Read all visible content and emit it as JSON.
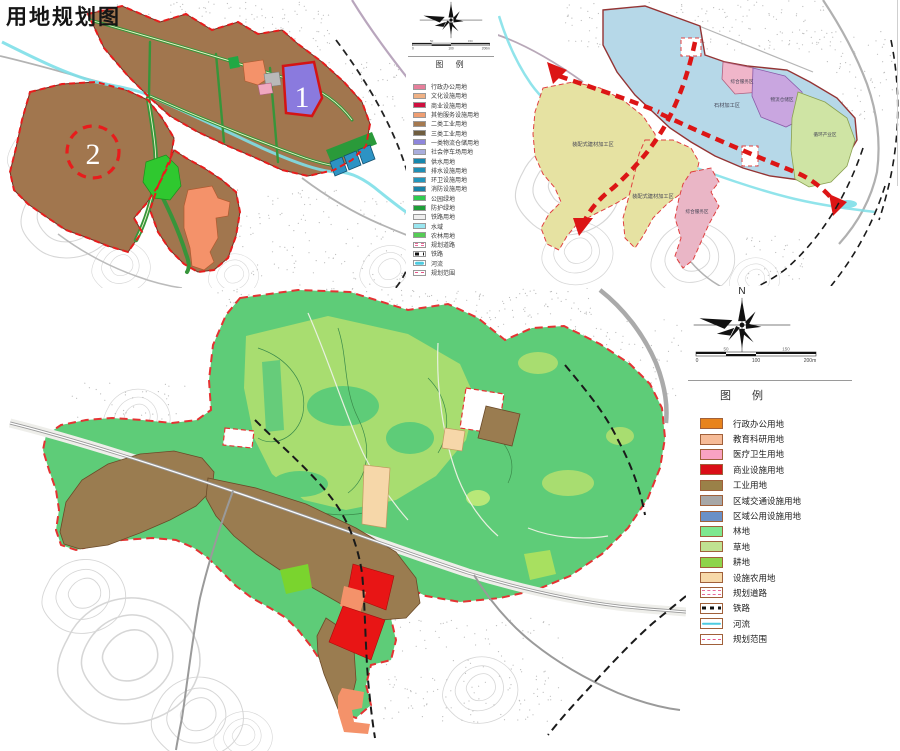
{
  "title": "用地规划图",
  "map1": {
    "marker_1": "1",
    "marker_2": "2"
  },
  "map2": {
    "zones": {
      "stone": "石材加工区",
      "prefab_west": "装配式建材加工区",
      "prefab_south": "装配式建材加工区",
      "service_top": "综合服务区",
      "logistics": "物流仓储区",
      "recycle": "循环产业区",
      "service_south": "综合服务区"
    }
  },
  "legend1": {
    "title": "图 例",
    "scale": {
      "start": "0",
      "mid": "100",
      "end": "200m",
      "upper_left": "50",
      "upper_right": "150"
    },
    "items": [
      {
        "label": "行政办公用地",
        "color": "#e67f9b",
        "style": "solid"
      },
      {
        "label": "文化设施用地",
        "color": "#efb184",
        "style": "solid"
      },
      {
        "label": "商业设施用地",
        "color": "#cf0f3f",
        "style": "solid"
      },
      {
        "label": "其他服务设施用地",
        "color": "#ef9e72",
        "style": "solid"
      },
      {
        "label": "二类工业用地",
        "color": "#a5794f",
        "style": "solid"
      },
      {
        "label": "三类工业用地",
        "color": "#6f5d3f",
        "style": "solid"
      },
      {
        "label": "一类物流仓储用地",
        "color": "#8e86dc",
        "style": "solid"
      },
      {
        "label": "社会停车场用地",
        "color": "#a9addc",
        "style": "solid"
      },
      {
        "label": "供水用地",
        "color": "#1787ad",
        "style": "solid"
      },
      {
        "label": "排水设施用地",
        "color": "#1f8fb5",
        "style": "solid"
      },
      {
        "label": "环卫设施用地",
        "color": "#2396bc",
        "style": "solid"
      },
      {
        "label": "消防设施用地",
        "color": "#1a83a8",
        "style": "solid"
      },
      {
        "label": "公园绿地",
        "color": "#2fcc4f",
        "style": "solid"
      },
      {
        "label": "防护绿地",
        "color": "#1e9e38",
        "style": "solid"
      },
      {
        "label": "铁路用地",
        "color": "#efefef",
        "style": "solid"
      },
      {
        "label": "水域",
        "color": "#9ae6f0",
        "style": "solid"
      },
      {
        "label": "农林用地",
        "color": "#55cc55",
        "style": "solid"
      },
      {
        "label": "规划道路",
        "style": "road"
      },
      {
        "label": "铁路",
        "style": "rail"
      },
      {
        "label": "河流",
        "style": "river"
      },
      {
        "label": "规划范围",
        "style": "boundary"
      }
    ]
  },
  "legend2": {
    "north": "N",
    "title": "图 例",
    "scale": {
      "start": "0",
      "mid": "100",
      "end": "200m",
      "upper_left": "50",
      "upper_right": "150"
    },
    "items": [
      {
        "label": "行政办公用地",
        "color": "#e8831c",
        "style": "solid"
      },
      {
        "label": "教育科研用地",
        "color": "#f6bb97",
        "style": "solid"
      },
      {
        "label": "医疗卫生用地",
        "color": "#f9a2c2",
        "style": "solid"
      },
      {
        "label": "商业设施用地",
        "color": "#da0f17",
        "style": "solid"
      },
      {
        "label": "工业用地",
        "color": "#9a8148",
        "style": "solid"
      },
      {
        "label": "区域交通设施用地",
        "color": "#a7a7a7",
        "style": "solid"
      },
      {
        "label": "区域公用设施用地",
        "color": "#6a90c7",
        "style": "solid"
      },
      {
        "label": "林地",
        "color": "#7fe78f",
        "style": "solid"
      },
      {
        "label": "草地",
        "color": "#c0e291",
        "style": "solid"
      },
      {
        "label": "耕地",
        "color": "#8ed44b",
        "style": "solid"
      },
      {
        "label": "设施农用地",
        "color": "#f7d9a9",
        "style": "solid"
      },
      {
        "label": "规划道路",
        "style": "road"
      },
      {
        "label": "铁路",
        "style": "rail"
      },
      {
        "label": "河流",
        "style": "river"
      },
      {
        "label": "规划范围",
        "style": "boundary"
      }
    ]
  },
  "colors": {
    "industrial_brown": "#a1764e",
    "planning_boundary_red": "#e81c1c",
    "green_road": "#37953a",
    "river_cyan": "#7edfe8",
    "forest_green": "#5ecc78",
    "grass_green": "#a8dd70",
    "commercial_red": "#e81515",
    "stone_zone_blue": "#b6d8e8",
    "prefab_zone_yellow": "#e6e2a2"
  }
}
